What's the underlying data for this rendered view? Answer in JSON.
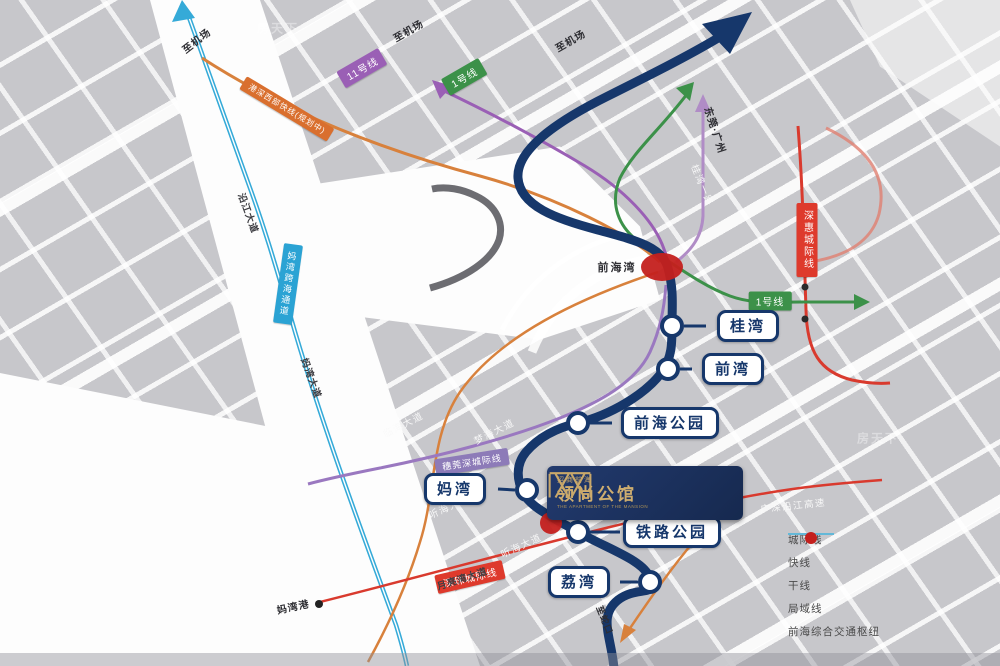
{
  "project": {
    "brand_small": "招商前海",
    "name": "领尚公馆",
    "name_en": "THE APARTMENT OF THE MANSION"
  },
  "stations": [
    {
      "name": "桂湾"
    },
    {
      "name": "前湾"
    },
    {
      "name": "前海公园"
    },
    {
      "name": "妈湾"
    },
    {
      "name": "铁路公园"
    },
    {
      "name": "荔湾"
    }
  ],
  "line_labels": {
    "line11": "11号线",
    "line1_top": "1号线",
    "line1_mid": "1号线",
    "hk_express": "港深西部快线(规划中)",
    "suiwanshen": "穗莞深城际线",
    "shenhui": "深惠城际线",
    "shenzhu": "深珠城际线",
    "mawan_tunnel": "妈湾跨海通道"
  },
  "roads": [
    "临海大道",
    "梦海大道",
    "听海大道",
    "月亮湾大道",
    "桂湾一路",
    "广深沿江高速",
    "妈湾大道",
    "沿江大道",
    "听海大道"
  ],
  "directions": {
    "to_airport": "至机场",
    "dongguan_guangzhou": "东莞·广州",
    "to_shekou": "至蛇口",
    "qianhaiwan": "前海湾",
    "mawan_port": "妈湾港"
  },
  "legend": {
    "items": [
      {
        "label": "城际线",
        "color": "#d9605a",
        "type": "line"
      },
      {
        "label": "快线",
        "color": "#6f9d6a",
        "type": "line"
      },
      {
        "label": "干线",
        "color": "#5c5c80",
        "type": "line"
      },
      {
        "label": "局域线",
        "color": "#63b8d8",
        "type": "line"
      },
      {
        "label": "前海综合交通枢纽",
        "color": "#c4201d",
        "type": "dot"
      }
    ]
  },
  "colors": {
    "main_line_navy": "#16376b",
    "metro_green": "#3c9149",
    "metro_purple": "#9a5fb5",
    "intercity_red": "#d93a2e",
    "local_cyan": "#35aad8",
    "express_orange": "#d8813c",
    "hub_red": "#c4201d",
    "logo_gold": "#c9a86a"
  },
  "watermark": "房天下"
}
